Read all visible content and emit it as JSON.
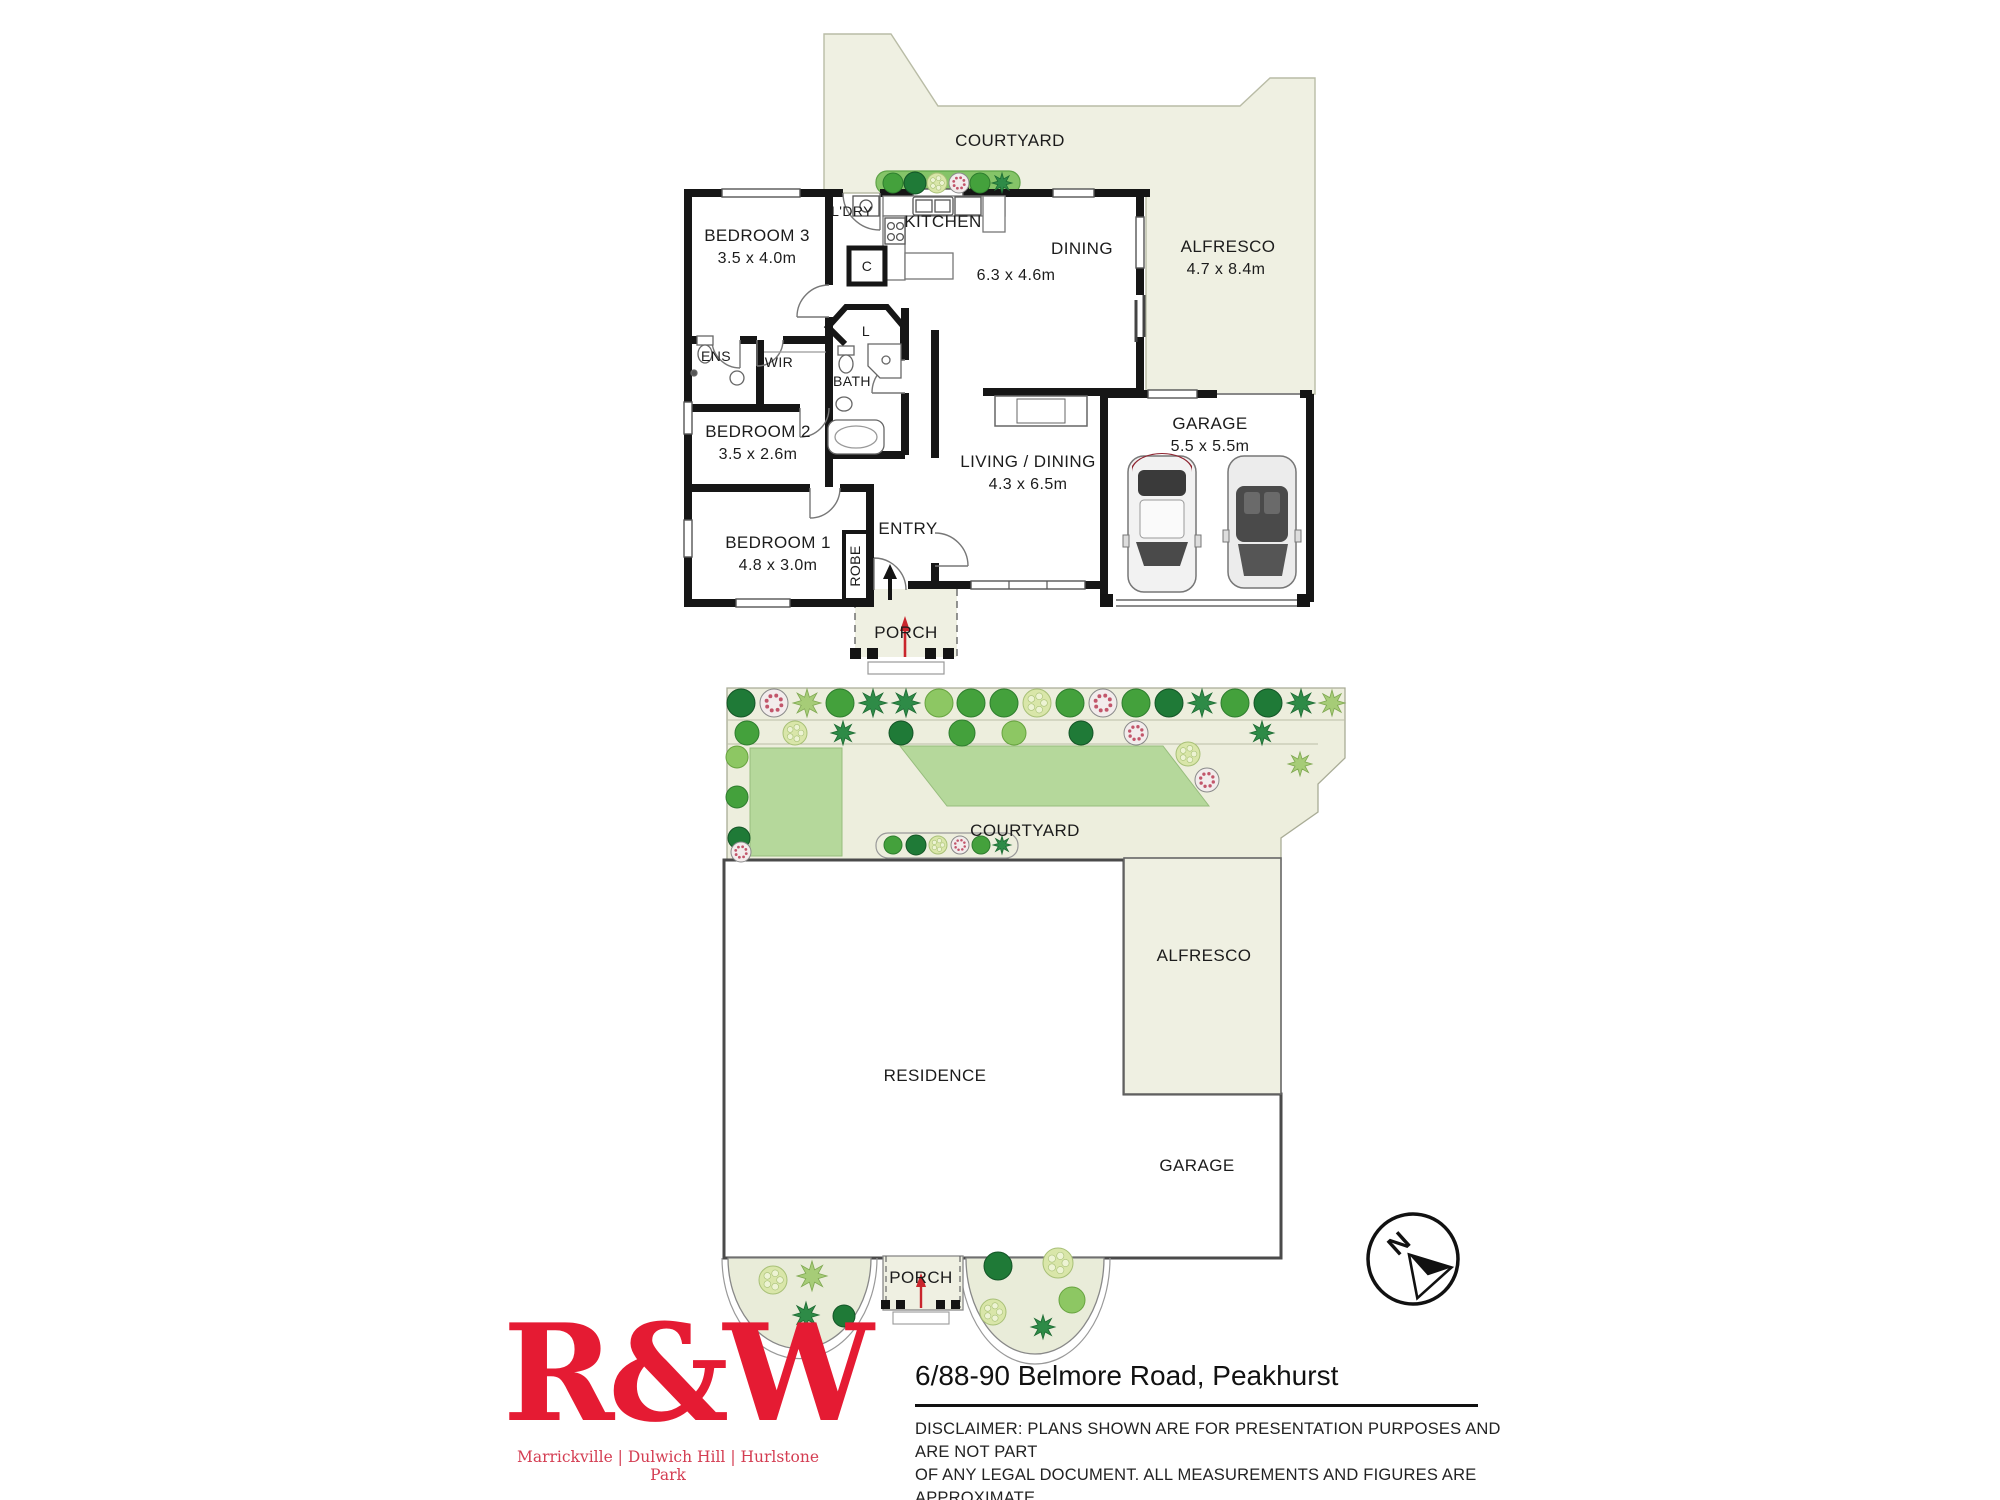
{
  "floor_plan": {
    "courtyard": "COURTYARD",
    "bedroom3": {
      "name": "BEDROOM 3",
      "dims": "3.5 x 4.0m"
    },
    "ldry": "L'DRY",
    "kitchen": "KITCHEN",
    "dw": "DW",
    "cupboard": "C",
    "dining": {
      "name": "DINING",
      "dims": "6.3 x 4.6m"
    },
    "alfresco": {
      "name": "ALFRESCO",
      "dims": "4.7 x 8.4m"
    },
    "ens": "ENS",
    "wir": "WIR",
    "linen": "L",
    "bath": "BATH",
    "bedroom2": {
      "name": "BEDROOM 2",
      "dims": "3.5 x 2.6m"
    },
    "garage": {
      "name": "GARAGE",
      "dims": "5.5 x 5.5m"
    },
    "living": {
      "name": "LIVING / DINING",
      "dims": "4.3 x 6.5m"
    },
    "bedroom1": {
      "name": "BEDROOM 1",
      "dims": "4.8 x 3.0m"
    },
    "robe": "ROBE",
    "entry": "ENTRY",
    "porch": "PORCH"
  },
  "site_plan": {
    "courtyard": "COURTYARD",
    "alfresco": "ALFRESCO",
    "residence": "RESIDENCE",
    "garage": "GARAGE",
    "porch": "PORCH"
  },
  "compass": {
    "north": "N"
  },
  "footer": {
    "logo": "R&W",
    "tagline": "Marrickville | Dulwich Hill | Hurlstone Park",
    "address": "6/88-90 Belmore Road, Peakhurst",
    "disclaimer_line1": "DISCLAIMER:  PLANS SHOWN ARE FOR PRESENTATION PURPOSES AND ARE NOT PART",
    "disclaimer_line2": "OF ANY LEGAL DOCUMENT. ALL MEASUREMENTS AND FIGURES ARE APPROXIMATE."
  },
  "colors": {
    "brand_red": "#E51B33",
    "wall_black": "#161616",
    "outdoor_beige": "#EFF0E2",
    "paving_beige": "#EDEEDD",
    "lawn_green": "#B5D89B",
    "garden_green": "#85C468",
    "arrow_red": "#C9252C"
  }
}
